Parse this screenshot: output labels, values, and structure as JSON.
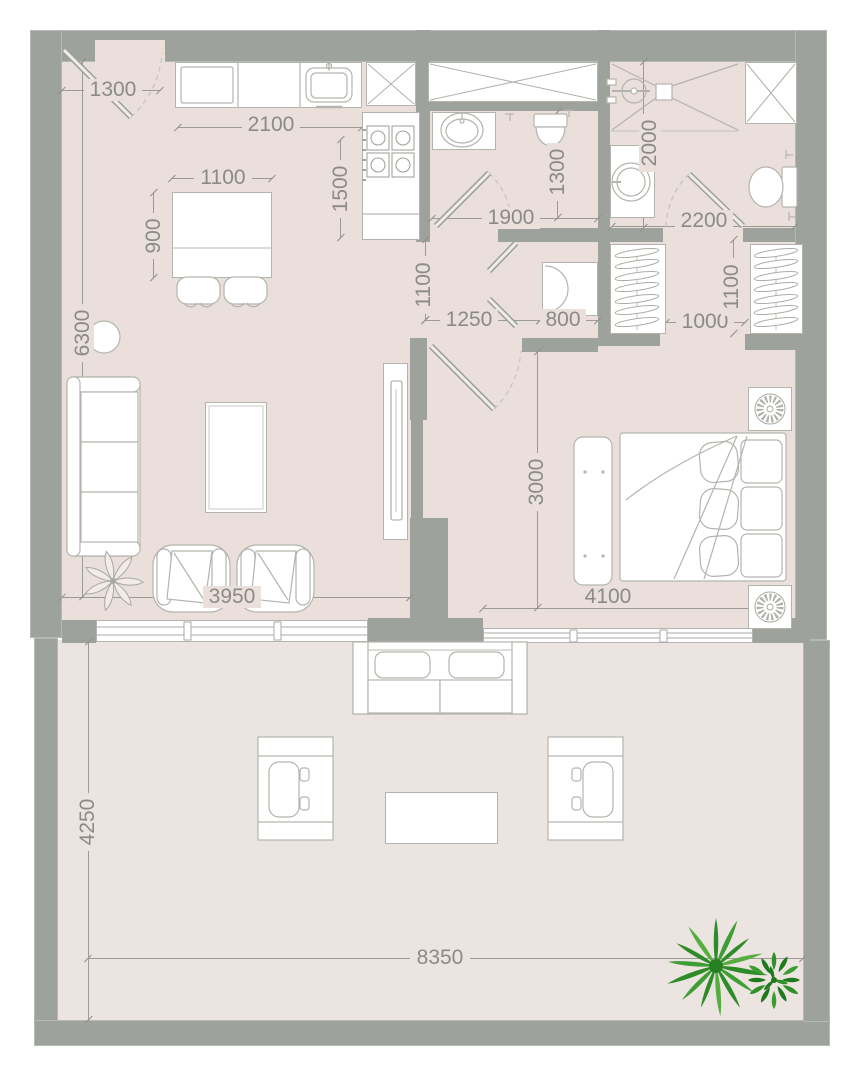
{
  "plan": {
    "type": "apartment-floor-plan",
    "units": "mm"
  },
  "colors": {
    "wall": "#9ea29d",
    "wall_edge": "#b6b9b3",
    "interior_floor": "#eadfda",
    "terrace_floor": "#ece4e0",
    "furniture_line": "#b4b4ae",
    "dimension_text": "#8b8b85",
    "palm_green_light": "#57ae40",
    "palm_green_mid": "#3f9e33",
    "palm_green_dark": "#2e8c28",
    "bush_green": "#1e7a1c"
  },
  "dims": {
    "entry_width": "1300",
    "kitchen_counter_width": "2100",
    "kitchen_counter_depth": "1500",
    "dining_table_width": "1100",
    "dining_table_depth": "900",
    "living_room_length": "6300",
    "hall_opening_width": "1100",
    "hall_length": "1250",
    "utility_closet_width": "800",
    "bathroom_width": "1900",
    "bathroom_depth": "1300",
    "shower_room_depth": "2000",
    "master_bathroom_width": "2200",
    "dressing_passage_width": "1000",
    "wardrobe_depth": "1100",
    "bedroom_depth": "3000",
    "bedroom_width": "4100",
    "living_room_width": "3950",
    "terrace_depth": "4250",
    "terrace_width": "8350"
  }
}
